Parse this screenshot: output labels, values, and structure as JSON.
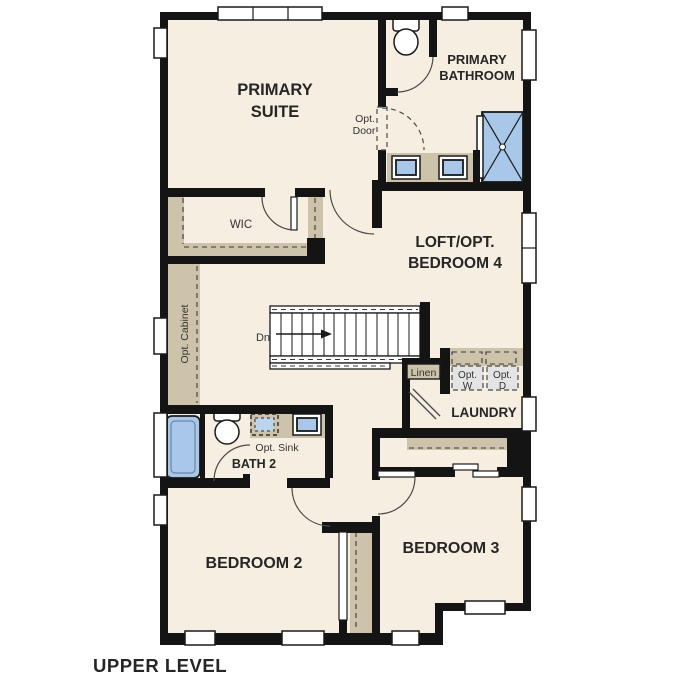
{
  "title": "UPPER LEVEL",
  "rooms": {
    "primary_suite": {
      "line1": "PRIMARY",
      "line2": "SUITE"
    },
    "primary_bathroom": {
      "line1": "PRIMARY",
      "line2": "BATHROOM"
    },
    "wic": {
      "label": "WIC"
    },
    "loft": {
      "line1": "LOFT/OPT.",
      "line2": "BEDROOM 4"
    },
    "laundry": {
      "label": "LAUNDRY"
    },
    "bath2": {
      "label": "BATH 2"
    },
    "bedroom2": {
      "label": "BEDROOM 2"
    },
    "bedroom3": {
      "label": "BEDROOM 3"
    }
  },
  "annotations": {
    "opt_door_line1": "Opt.",
    "opt_door_line2": "Door",
    "opt_cabinet": "Opt. Cabinet",
    "stairs_direction": "Dn",
    "linen": "Linen",
    "opt_washer_line1": "Opt.",
    "opt_washer_line2": "W",
    "opt_dryer_line1": "Opt.",
    "opt_dryer_line2": "D",
    "opt_sink": "Opt. Sink"
  },
  "colors": {
    "wall": "#141414",
    "floor": "#f6efe1",
    "mill": "#cdc3ab",
    "fixture": "#a9c7e8",
    "appliance": "#e4e4e4"
  }
}
